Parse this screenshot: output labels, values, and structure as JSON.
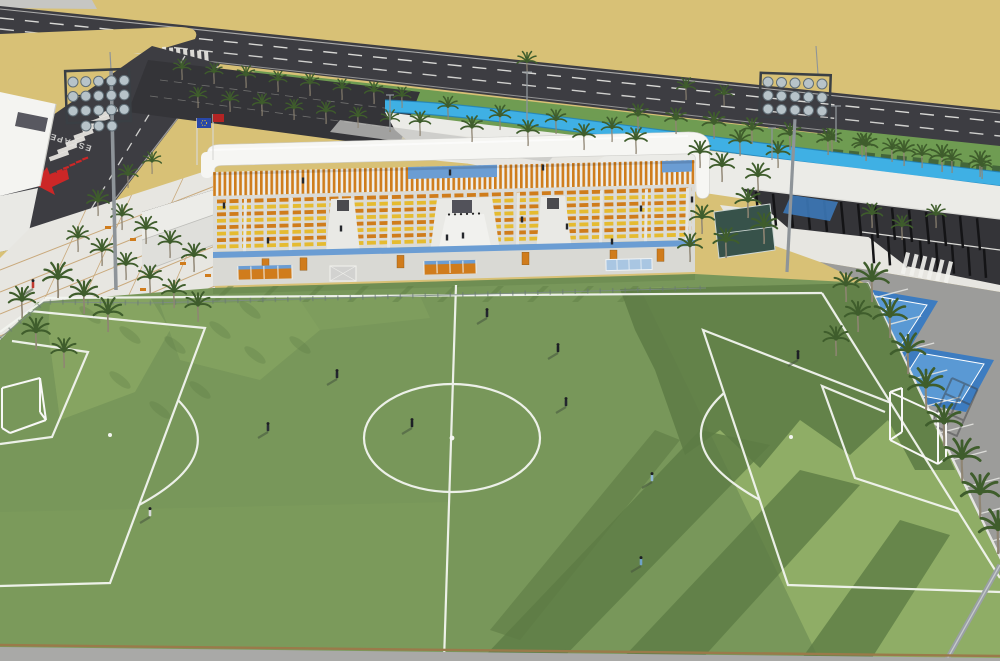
{
  "road_marking": {
    "text": "ESCAPE"
  },
  "colors": {
    "sand": "#d8c176",
    "road": "#3d3d42",
    "laneWhite": "#eceae6",
    "sidewalk": "#c6c6c3",
    "plaza": "#e7e6e1",
    "plazaGrid": "#c29a62",
    "lawn": "#6f9c52",
    "hedge": "#44663a",
    "palmGreen": "#3f5d2c",
    "palmTrunk": "#8f8573",
    "bikeCyan": "#3fb0e4",
    "bikeEdge": "#1f7fb8",
    "promenade": "#ebebe7",
    "parkingDark": "#343438",
    "parkingGray": "#9c9c9a",
    "roofWhite": "#f6f6f3",
    "slatOrange": "#cf7d1d",
    "slatWhite": "#efefec",
    "seatOrange": "#cf7c1b",
    "seatYellow": "#e5bb30",
    "standConcrete": "#dbdbd7",
    "standBlue": "#6b9dd3",
    "wallLight": "#d9d9d4",
    "doorOrange": "#d07c1c",
    "fieldBase": "#78975a",
    "fieldLight": "#8fad66",
    "fieldShadow": "#5d7c45",
    "lineWhite": "#f3f5f0",
    "lampGray": "#b7c3c9",
    "poleGray": "#8e9499",
    "frameDark": "#3a3f44",
    "arrowRed": "#cc2727",
    "flagBlue": "#2847a8",
    "flagRed": "#b32424",
    "courtBlue": "#3d7cc0",
    "courtBlueLight": "#5a99d4",
    "tanLine": "#9a7a4a",
    "figureDark": "#24262b"
  },
  "scene": {
    "stand": {
      "seat_rows": 8,
      "vomitories": 3,
      "dugouts": 2
    },
    "floodlights": {
      "left_lamps": 18,
      "right_lamps": 15
    },
    "palms": [
      [
        527,
        75,
        0.9
      ],
      [
        686,
        100,
        0.85
      ],
      [
        724,
        106,
        0.8
      ],
      [
        638,
        130,
        1
      ],
      [
        676,
        134,
        1
      ],
      [
        714,
        139,
        1.05
      ],
      [
        752,
        144,
        1
      ],
      [
        790,
        150,
        1.05
      ],
      [
        828,
        155,
        1
      ],
      [
        866,
        161,
        1.05
      ],
      [
        904,
        166,
        1
      ],
      [
        942,
        172,
        1.05
      ],
      [
        980,
        177,
        1
      ],
      [
        182,
        80,
        0.8
      ],
      [
        214,
        84,
        0.8
      ],
      [
        246,
        88,
        0.85
      ],
      [
        278,
        92,
        0.8
      ],
      [
        310,
        96,
        0.85
      ],
      [
        342,
        100,
        0.8
      ],
      [
        374,
        104,
        0.85
      ],
      [
        402,
        108,
        0.8
      ],
      [
        198,
        108,
        0.8
      ],
      [
        230,
        112,
        0.8
      ],
      [
        262,
        116,
        0.85
      ],
      [
        294,
        120,
        0.8
      ],
      [
        326,
        124,
        0.85
      ],
      [
        358,
        128,
        0.8
      ],
      [
        390,
        132,
        0.85
      ],
      [
        420,
        136,
        0.95
      ],
      [
        448,
        120,
        0.9
      ],
      [
        472,
        142,
        1
      ],
      [
        500,
        130,
        0.95
      ],
      [
        528,
        146,
        1
      ],
      [
        556,
        134,
        0.95
      ],
      [
        584,
        150,
        1
      ],
      [
        612,
        142,
        0.95
      ],
      [
        636,
        154,
        1
      ],
      [
        700,
        168,
        1.05
      ],
      [
        722,
        182,
        1.1
      ],
      [
        740,
        156,
        1
      ],
      [
        758,
        192,
        1.1
      ],
      [
        778,
        168,
        1.05
      ],
      [
        748,
        218,
        1.15
      ],
      [
        764,
        244,
        1.2
      ],
      [
        726,
        258,
        1.15
      ],
      [
        702,
        234,
        1.1
      ],
      [
        690,
        262,
        1.1
      ],
      [
        832,
        152,
        0.9
      ],
      [
        862,
        157,
        0.9
      ],
      [
        892,
        162,
        0.9
      ],
      [
        922,
        168,
        0.9
      ],
      [
        952,
        173,
        0.9
      ],
      [
        982,
        179,
        0.9
      ],
      [
        98,
        216,
        1
      ],
      [
        122,
        230,
        1
      ],
      [
        146,
        244,
        1.05
      ],
      [
        170,
        258,
        1.05
      ],
      [
        194,
        272,
        1.1
      ],
      [
        78,
        252,
        1
      ],
      [
        102,
        266,
        1.05
      ],
      [
        126,
        280,
        1.05
      ],
      [
        150,
        294,
        1.1
      ],
      [
        174,
        308,
        1.1
      ],
      [
        198,
        322,
        1.15
      ],
      [
        128,
        188,
        0.9
      ],
      [
        152,
        174,
        0.85
      ],
      [
        58,
        298,
        1.35
      ],
      [
        84,
        314,
        1.3
      ],
      [
        108,
        332,
        1.3
      ],
      [
        36,
        350,
        1.25
      ],
      [
        64,
        368,
        1.15
      ],
      [
        22,
        318,
        1.2
      ],
      [
        872,
        302,
        1.5
      ],
      [
        890,
        338,
        1.5
      ],
      [
        908,
        374,
        1.55
      ],
      [
        926,
        410,
        1.6
      ],
      [
        944,
        446,
        1.6
      ],
      [
        962,
        482,
        1.65
      ],
      [
        980,
        518,
        1.7
      ],
      [
        998,
        554,
        1.7
      ],
      [
        846,
        302,
        1.15
      ],
      [
        858,
        332,
        1.2
      ],
      [
        836,
        356,
        1.15
      ],
      [
        872,
        228,
        0.95
      ],
      [
        902,
        240,
        0.95
      ],
      [
        936,
        228,
        0.9
      ]
    ],
    "players": [
      [
        337,
        378,
        "#23262e"
      ],
      [
        412,
        427,
        "#1d2026"
      ],
      [
        268,
        431,
        "#2a2e36"
      ],
      [
        487,
        317,
        "#23262e"
      ],
      [
        558,
        352,
        "#1d2026"
      ],
      [
        566,
        406,
        "#23262e"
      ],
      [
        652,
        481,
        "#8fb6d2"
      ],
      [
        798,
        359,
        "#1d2026"
      ],
      [
        150,
        516,
        "#d7d9da"
      ],
      [
        641,
        565,
        "#6fa2c8"
      ],
      [
        33,
        288,
        "#c03a30"
      ]
    ],
    "stand_people": [
      [
        224,
        208
      ],
      [
        268,
        243
      ],
      [
        341,
        231
      ],
      [
        447,
        240
      ],
      [
        463,
        238
      ],
      [
        522,
        222
      ],
      [
        567,
        229
      ],
      [
        612,
        244
      ],
      [
        641,
        211
      ],
      [
        692,
        202
      ],
      [
        303,
        183
      ],
      [
        450,
        175
      ],
      [
        543,
        170
      ]
    ]
  }
}
